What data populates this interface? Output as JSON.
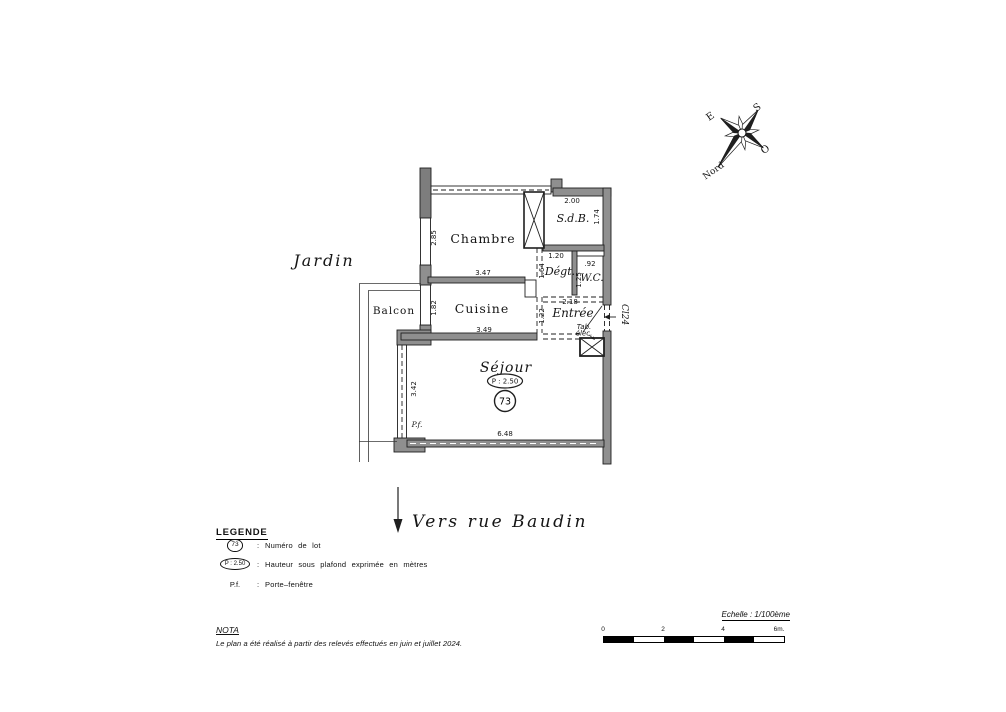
{
  "colors": {
    "wall": "#8f8f8f",
    "wall_dark": "#7d7d7d",
    "ink": "#1f1f1f"
  },
  "plan": {
    "garden": "Jardin",
    "balcony": "Balcon",
    "street": "Vers  rue  Baudin",
    "rooms": {
      "chambre": {
        "name": "Chambre",
        "width": "3.47",
        "height": "2.85"
      },
      "sdb": {
        "name": "S.d.B.",
        "width": "2.00",
        "height": "1.74"
      },
      "degt": {
        "name": "Dégt.",
        "width": "1.20",
        "height": "1.64"
      },
      "wc": {
        "name": "W.C.",
        "width": ".92",
        "height": "1.25"
      },
      "cuisine": {
        "name": "Cuisine",
        "width": "3.49",
        "height": "1.82"
      },
      "entree": {
        "name": "Entrée",
        "width": "2.18",
        "height": "1.22"
      },
      "sejour": {
        "name": "Séjour",
        "width": "6.48",
        "height": "3.42"
      }
    },
    "markers": {
      "lot_number": "73",
      "ceiling_height": "P : 2.50",
      "porte_fenetre": "P.f."
    },
    "annotations": {
      "elec_panel_1": "Tab.",
      "elec_panel_2": "élec.",
      "door_ref": "Cl24"
    }
  },
  "compass": {
    "north": "Nord",
    "south": "S",
    "east": "E",
    "west": "O"
  },
  "legend": {
    "title": "LEGENDE",
    "colon": ":",
    "items": [
      {
        "symbol": "73",
        "text": "Numéro de lot"
      },
      {
        "symbol": "P : 2.50",
        "text": "Hauteur sous plafond exprimée en mètres"
      },
      {
        "symbol": "P.f.",
        "text": "Porte–fenêtre"
      }
    ]
  },
  "nota": {
    "title": "NOTA",
    "text": "Le plan a été réalisé à partir des relevés effectués en juin et juillet 2024."
  },
  "scale_bar": {
    "label": "Echelle : 1/100ème",
    "ticks": [
      "0",
      "2",
      "4",
      "6m."
    ]
  }
}
